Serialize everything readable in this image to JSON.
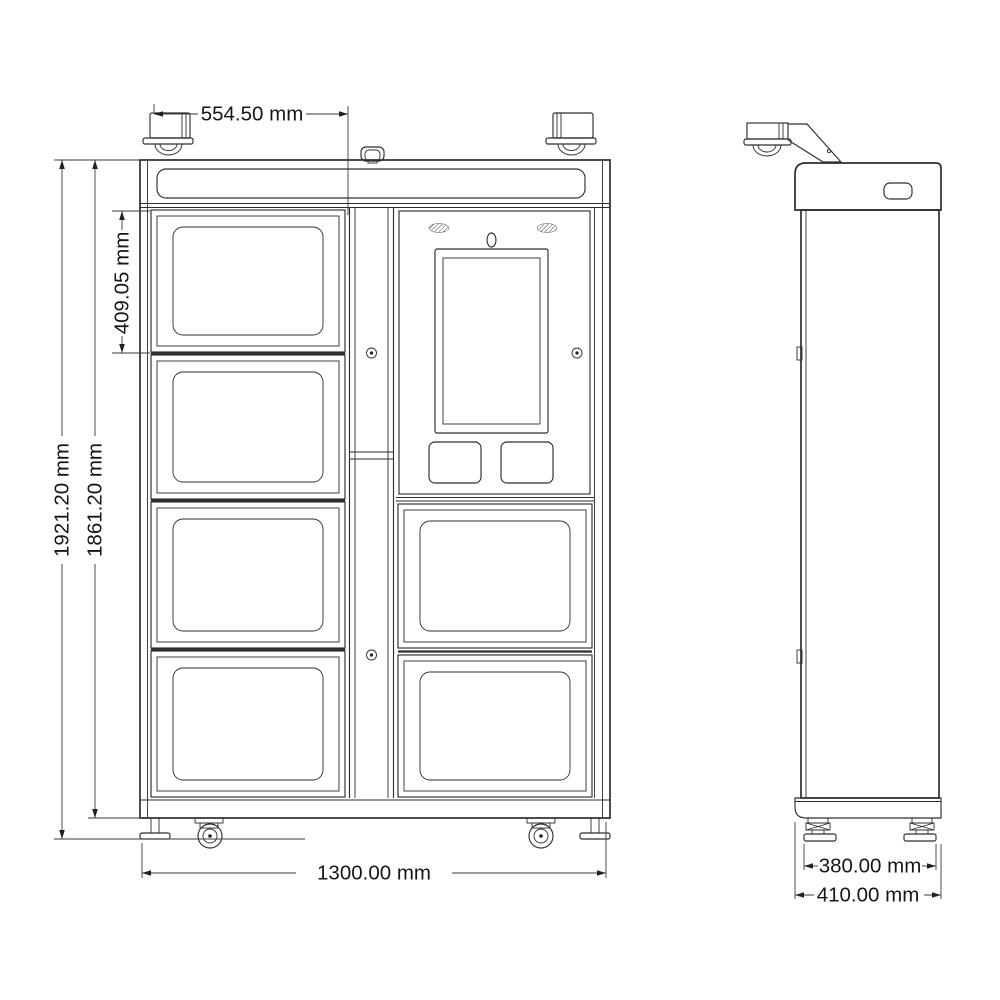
{
  "drawing": {
    "colors": {
      "background": "#ffffff",
      "line": "#2e2e2e",
      "dimension_line": "#3a3a3a",
      "text": "#161616"
    },
    "front_view": {
      "dimensions": {
        "top_width": {
          "label": "554.50 mm"
        },
        "compartment_height": {
          "label": "409.05 mm"
        },
        "overall_height": {
          "label": "1921.20 mm"
        },
        "cabinet_height": {
          "label": "1861.20 mm"
        },
        "overall_width": {
          "label": "1300.00 mm"
        }
      }
    },
    "side_view": {
      "dimensions": {
        "foot_track": {
          "label": "380.00 mm"
        },
        "overall_depth": {
          "label": "410.00 mm"
        }
      }
    }
  }
}
